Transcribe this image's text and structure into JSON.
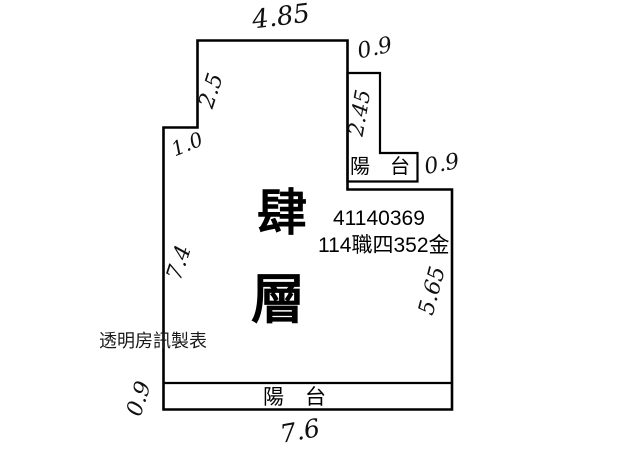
{
  "floorplan": {
    "floor_label": {
      "char_top": "肆",
      "char_bottom": "層"
    },
    "license_number": "41140369",
    "doc_code": "114職四352金",
    "watermark": "透明房訊製表",
    "top_balcony_label": "陽　台",
    "bottom_balcony_label": "陽　台",
    "dimensions": {
      "top_width": "4.85",
      "top_step_width": "0.9",
      "upper_left_height": "2.5",
      "left_step_width": "1.0",
      "top_balcony_height": "2.45",
      "top_balcony_width": "0.9",
      "left_height": "7.4",
      "right_height": "5.65",
      "bottom_balcony_height": "0.9",
      "bottom_width": "7.6"
    },
    "colors": {
      "line": "#000000",
      "background": "#ffffff"
    }
  }
}
